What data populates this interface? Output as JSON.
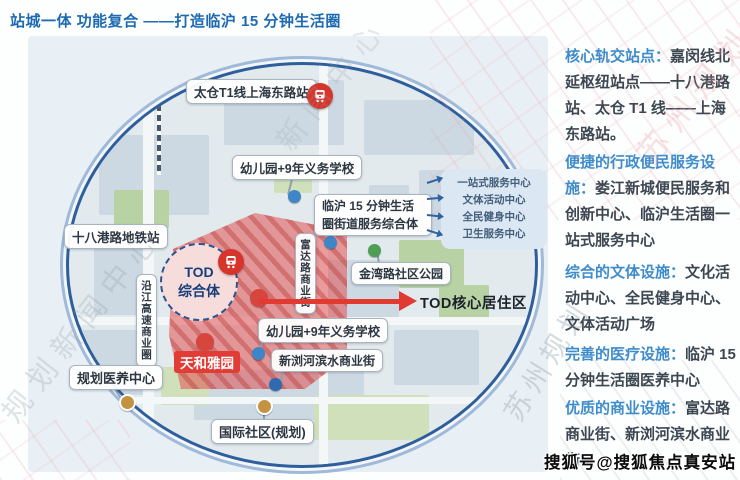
{
  "title": "站城一体 功能复合 ——打造临沪 15 分钟生活圈",
  "map": {
    "station_t1": "太仓T1线上海东路站",
    "station_shibagang": "十八港路地铁站",
    "school_top": "幼儿园+9年义务学校",
    "school_bottom": "幼儿园+9年义务学校",
    "service_hub_line1": "临沪 15 分钟生活",
    "service_hub_line2": "圈街道服务综合体",
    "services": [
      "一站式服务中心",
      "文体活动中心",
      "全民健身中心",
      "卫生服务中心"
    ],
    "tod_line1": "TOD",
    "tod_line2": "综合体",
    "yanjiang_strip": "沿江高速商业圈",
    "fuda_street": "富达路商业街",
    "jinwan_park": "金湾路社区公园",
    "core_area": "TOD核心居住区",
    "xinliu_street": "新浏河滨水商业街",
    "tianhe_estate": "天和雅园",
    "medical_center": "规划医养中心",
    "intl_community": "国际社区(规划)"
  },
  "panel": {
    "items": [
      {
        "heading": "核心轨交站点：",
        "body": "嘉闵线北延枢纽站点——十八港路站、太仓 T1 线——上海东路站。"
      },
      {
        "heading": "便捷的行政便民服务设施：",
        "body": "娄江新城便民服务和创新中心、临沪生活圈一站式服务中心"
      },
      {
        "heading": "综合的文体设施：",
        "body": "文化活动中心、全民健身中心、文体活动广场"
      },
      {
        "heading": "完善的医疗设施：",
        "body": "临沪 15 分钟生活圈医养中心"
      },
      {
        "heading": "优质的商业设施：",
        "body": "富达路商业街、新浏河滨水商业街"
      }
    ]
  },
  "watermarks": {
    "sohu": "搜狐号@搜狐焦点真安站",
    "wm_left": "规划新闻中心",
    "wm_top": "新闻中心",
    "wm_right": "苏州规划"
  },
  "colors": {
    "title_blue": "#1d6ab2",
    "heading_blue": "#3f8ccb",
    "body_text": "#3d4752",
    "map_ring_navy": "#2e5f9c",
    "map_ring_light": "#9fb9d8",
    "red_zone": "#e05252",
    "red_accent": "#e13a30",
    "metro_red": "#d6352b",
    "marker_blue": "#3f86c8",
    "marker_gold": "#c29340",
    "marker_green": "#4f9e53"
  }
}
